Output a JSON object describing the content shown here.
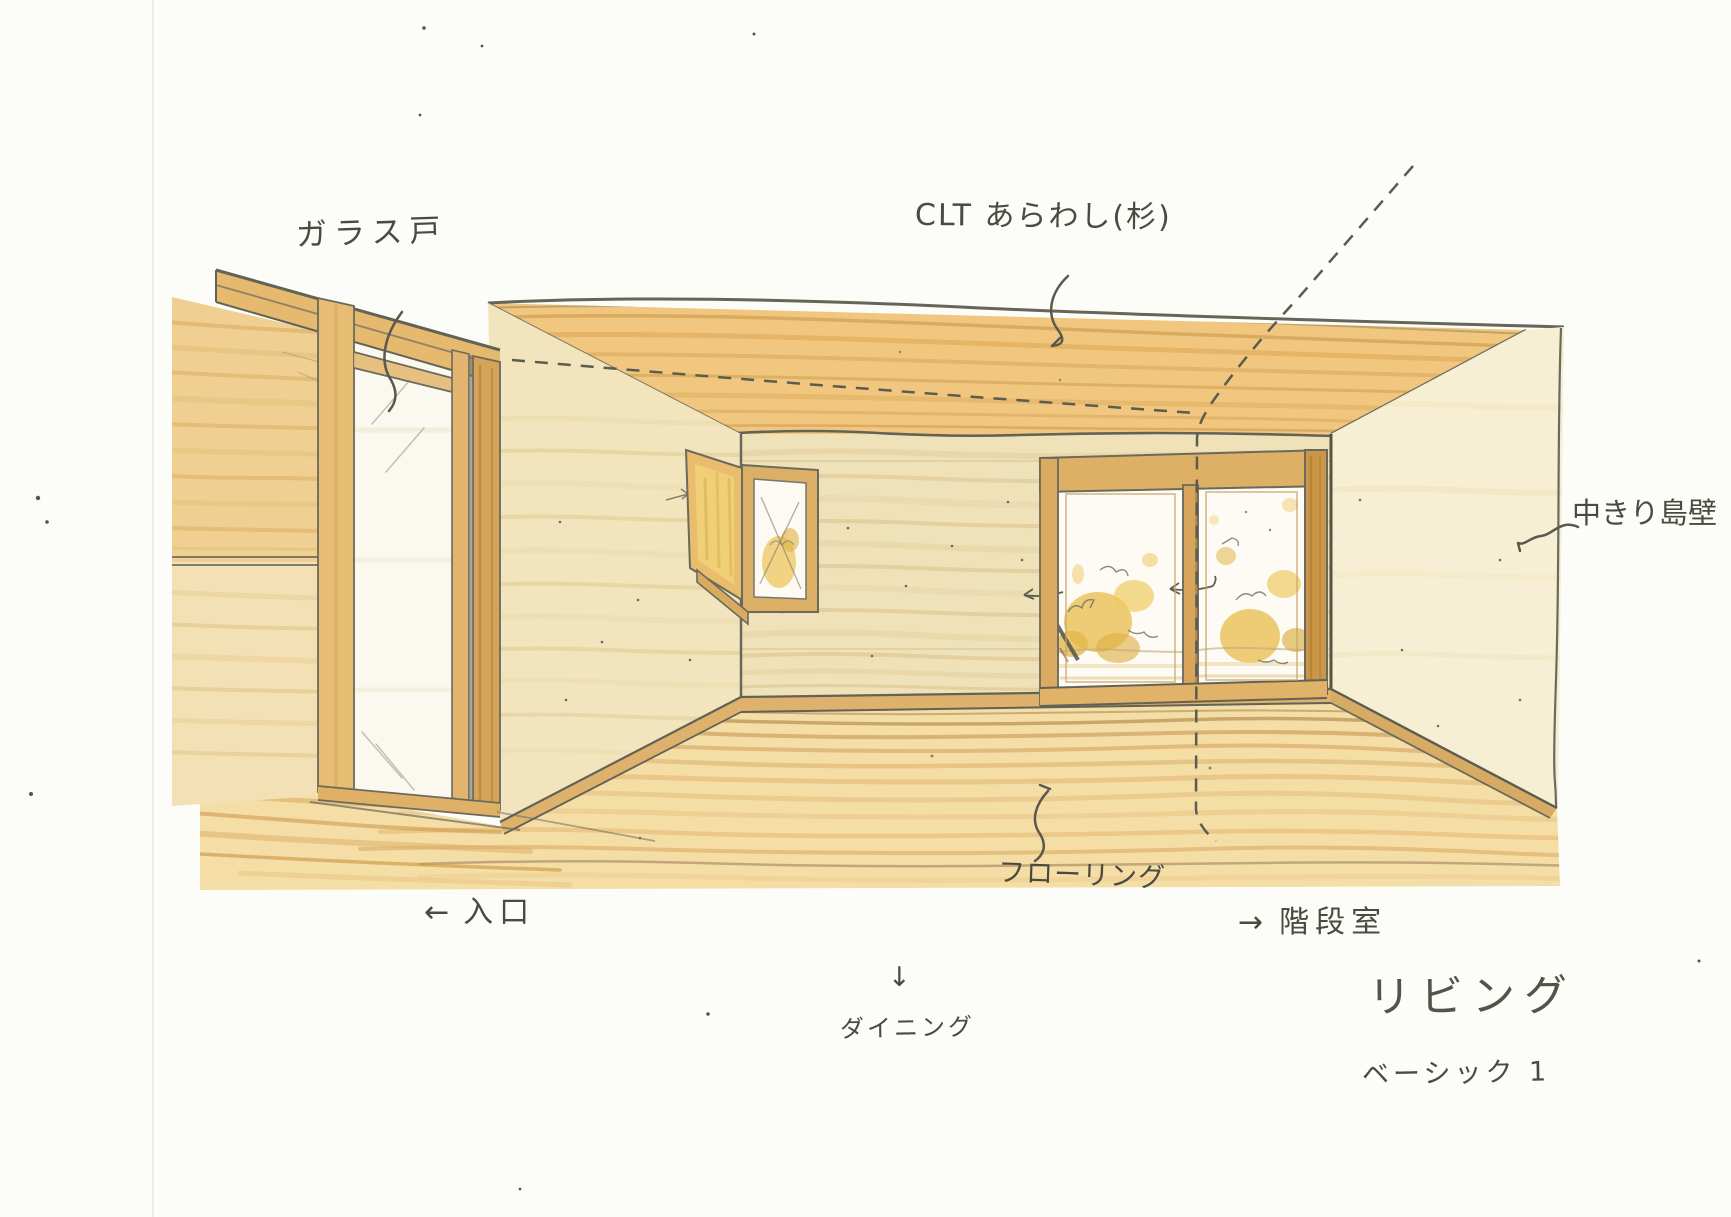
{
  "sketch": {
    "room_title": "リビング",
    "variant": "ベーシック 1",
    "annotations": {
      "glass_door": "ガラス戸",
      "ceiling_clt": "CLT あらわし(杉)",
      "partition_wall": "中きり島壁",
      "flooring": "フローリング",
      "entrance": {
        "arrow": "←",
        "label": "入口"
      },
      "stairwell": {
        "arrow": "→",
        "label": "階段室"
      },
      "dining": {
        "arrow": "↓",
        "label": "ダイニング"
      }
    },
    "palette": {
      "paper": "#fcfcf8",
      "pencil_line": "#6b6a5c",
      "ink_text": "#4b4a40",
      "ceiling_wood": "#f1c77f",
      "back_wall": "#efe1b8",
      "left_wall": "#f2e5bd",
      "right_wall": "#f7efd3",
      "floor_wood": "#f5dda6",
      "frame_wood": "#deb066",
      "foliage_yellow": "#e9c155"
    }
  }
}
